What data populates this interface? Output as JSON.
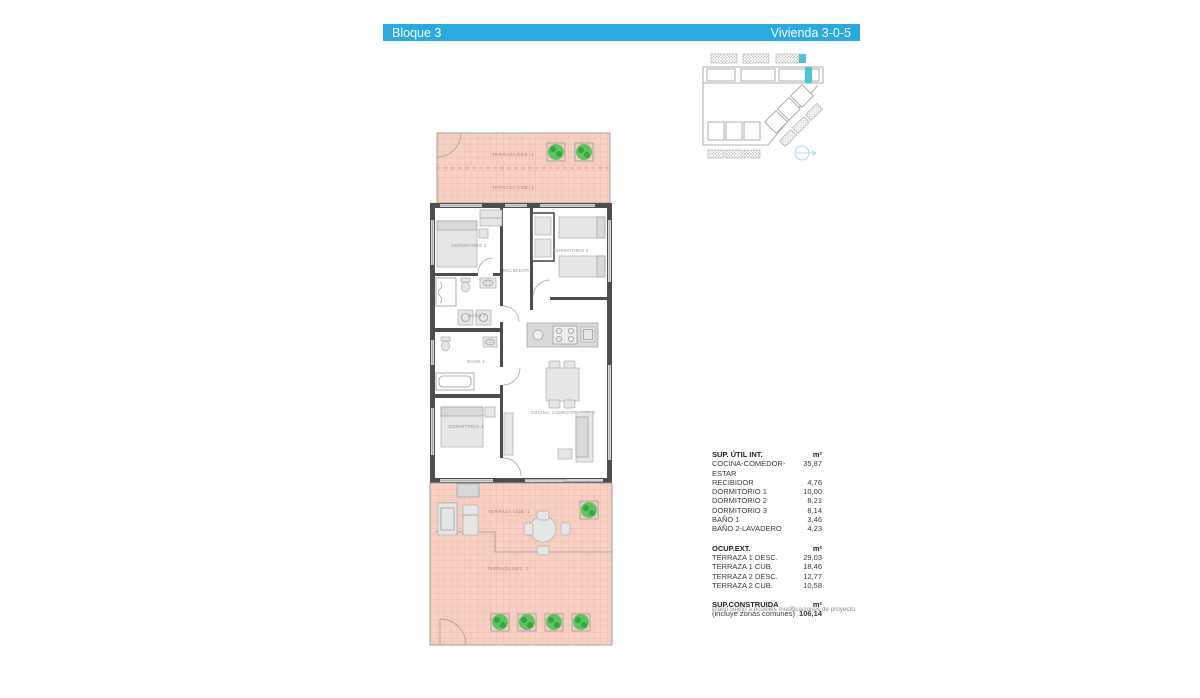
{
  "header": {
    "left": "Bloque 3",
    "right": "Vivienda 3-0-5"
  },
  "plan": {
    "labels": {
      "terraza_des_2": "TERRAZA DES. 2",
      "terraza_cub_2": "TERRAZA CUB. 2",
      "dormitorio_2": "DORMITORIO 2",
      "recibidor": "RECIBIDOR",
      "dormitorio_3": "DORMITORIO 3",
      "bano_2": "BAÑO 2",
      "bano_1": "BAÑO 1",
      "dormitorio_1": "DORMITORIO 1",
      "cocina": "COCINA, COMEDOR, ESTAR",
      "terraza_cub_1": "TERRAZA CUB. 1",
      "terraza_des_1": "TERRAZA DES. 1"
    }
  },
  "tables": {
    "sup_util": {
      "title": "SUP. ÚTIL INT.",
      "unit": "m²",
      "rows": [
        {
          "label": "COCINA-COMEDOR-ESTAR",
          "value": "35,87"
        },
        {
          "label": "RECIBIDOR",
          "value": "4,76"
        },
        {
          "label": "DORMITORIO 1",
          "value": "10,00"
        },
        {
          "label": "DORMITORIO 2",
          "value": "8,21"
        },
        {
          "label": "DORMITORIO 3",
          "value": "8,14"
        },
        {
          "label": "BAÑO 1",
          "value": "3,46"
        },
        {
          "label": "BAÑO 2-LAVADERO",
          "value": "4,23"
        }
      ]
    },
    "ocup_ext": {
      "title": "OCUP.EXT.",
      "unit": "m²",
      "rows": [
        {
          "label": "TERRAZA 1 DESC.",
          "value": "29,03"
        },
        {
          "label": "TERRAZA 1 CUB.",
          "value": "18,46"
        },
        {
          "label": "TERRAZA 2 DESC.",
          "value": "12,77"
        },
        {
          "label": "TERRAZA 2 CUB.",
          "value": "10,58"
        }
      ]
    },
    "sup_construida": {
      "title": "SUP.CONSTRUIDA",
      "unit": "m²",
      "note": "(incluye zonas comunes)",
      "value": "106,14"
    }
  },
  "footer_note": "Plano sujeto a posibles modificaciones de proyecto",
  "colors": {
    "accent": "#29abe2",
    "accent2": "#4fc3d4",
    "terrace_fill": "#f7cfc3",
    "terrace_grid": "#eca996",
    "wall": "#4d4d4d",
    "plant": "#4ec453"
  }
}
